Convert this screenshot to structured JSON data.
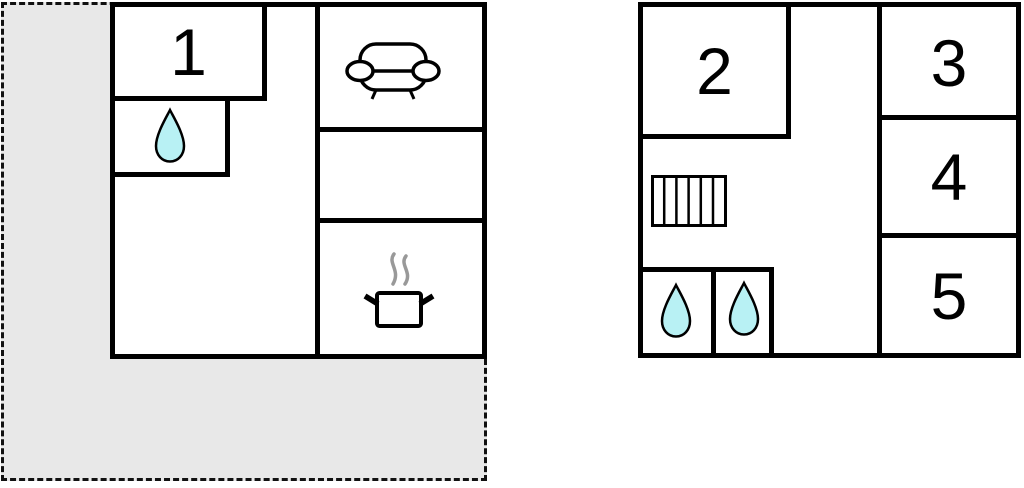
{
  "colors": {
    "wall": "#000000",
    "terrace_fill": "#e8e8e8",
    "water_fill": "#b8f1f4",
    "steam": "#999999",
    "background": "#ffffff"
  },
  "building_left": {
    "rooms": {
      "room1": "1"
    },
    "icons": [
      "water-drop-icon",
      "sofa-icon",
      "cooking-pot-icon"
    ],
    "has_terrace": "dashed gray outdoor area"
  },
  "building_right": {
    "rooms": {
      "room2": "2",
      "room3": "3",
      "room4": "4",
      "room5": "5"
    },
    "icons": [
      "stairs-icon",
      "water-drop-icon",
      "water-drop-icon"
    ]
  }
}
